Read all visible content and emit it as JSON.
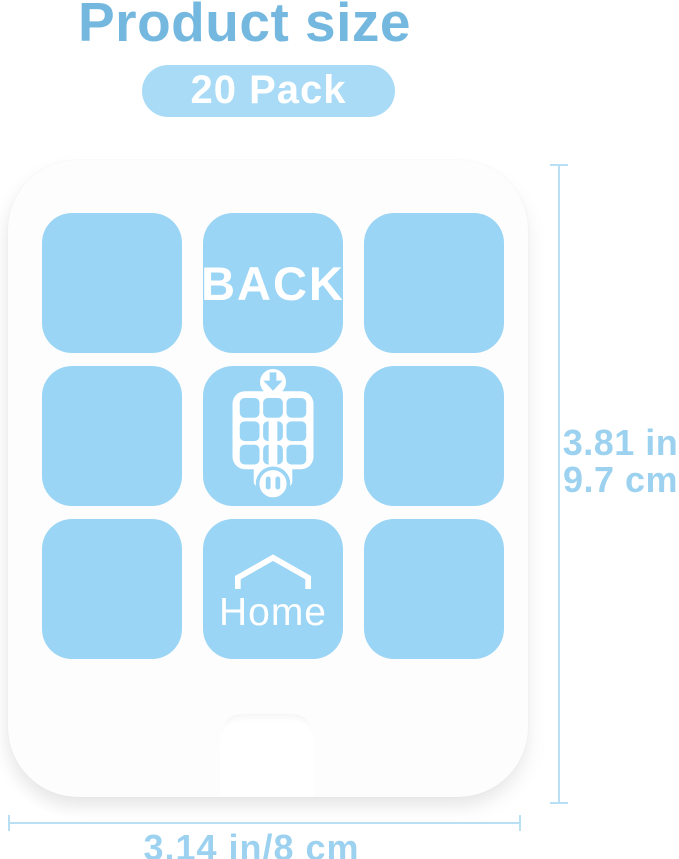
{
  "header": {
    "title": "Product size",
    "badge_label": "20 Pack"
  },
  "product_card": {
    "back_label": "BACK",
    "home_label": "Home",
    "grid": {
      "rows": 3,
      "cols": 3
    },
    "icons": [
      "down-arrow-icon",
      "plug-night-light-icon",
      "outlet-icon",
      "house-roof-icon"
    ]
  },
  "dimensions": {
    "height_in": "3.81 in",
    "height_cm": "9.7 cm",
    "width_label": "3.14 in/8 cm"
  },
  "colors": {
    "title_blue": "#74b8df",
    "badge_bg": "#a9dbf6",
    "badge_text": "#ffffff",
    "pad_blue": "#9bd5f5",
    "card_bg": "#fdfdfd",
    "dim_line": "#b8dff3",
    "dim_text": "#9cd2f0",
    "background": "#ffffff"
  }
}
